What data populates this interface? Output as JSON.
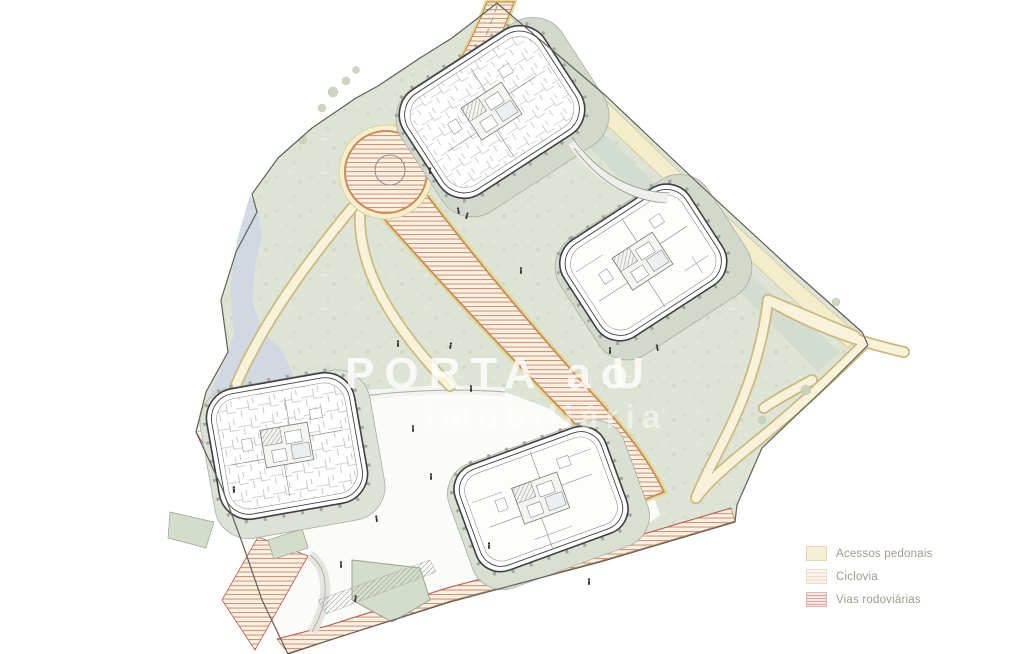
{
  "legend": {
    "items": [
      {
        "id": "pedestrian",
        "label": "Acessos pedonais"
      },
      {
        "id": "ciclovia",
        "label": "Ciclovia"
      },
      {
        "id": "roads",
        "label": "Vias rodoviárias"
      }
    ]
  },
  "watermark": {
    "line1": "PORTA ao",
    "line1_cont": "U",
    "line2": "imobiliária"
  },
  "colors": {
    "terrain": "#dde4d5",
    "pond": "#cfd6e2",
    "path_fill": "#f8f2da",
    "path_edge": "#cdb97e",
    "road_fill": "#f9f2e0",
    "road_stripe": "#d6917f",
    "road_border": "#cf8a55",
    "road_outer_edge": "#e0da96",
    "boundary": "#5f6159",
    "building_outline": "#404040",
    "slab": "#d2d9cc",
    "legend_text": "#a09a8e",
    "watermark": "#ffffff"
  }
}
